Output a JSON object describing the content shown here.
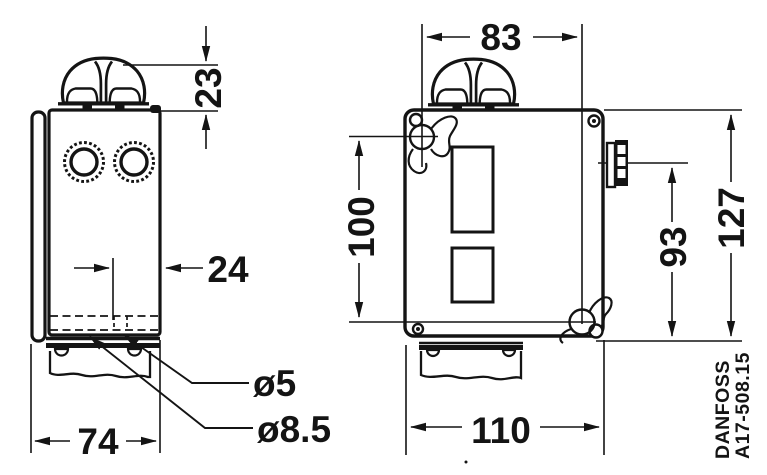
{
  "drawing": {
    "side_view": {
      "knob_height": "23",
      "hole_offset": "24",
      "hole_small": "ø5",
      "hole_large": "ø8.5",
      "width": "74"
    },
    "front_view": {
      "mount_span_x": "83",
      "mount_span_y": "100",
      "connector_height": "93",
      "total_height": "127",
      "width": "110"
    },
    "footer": {
      "brand": "DANFOSS",
      "doc_ref": "A17-508.15"
    }
  }
}
